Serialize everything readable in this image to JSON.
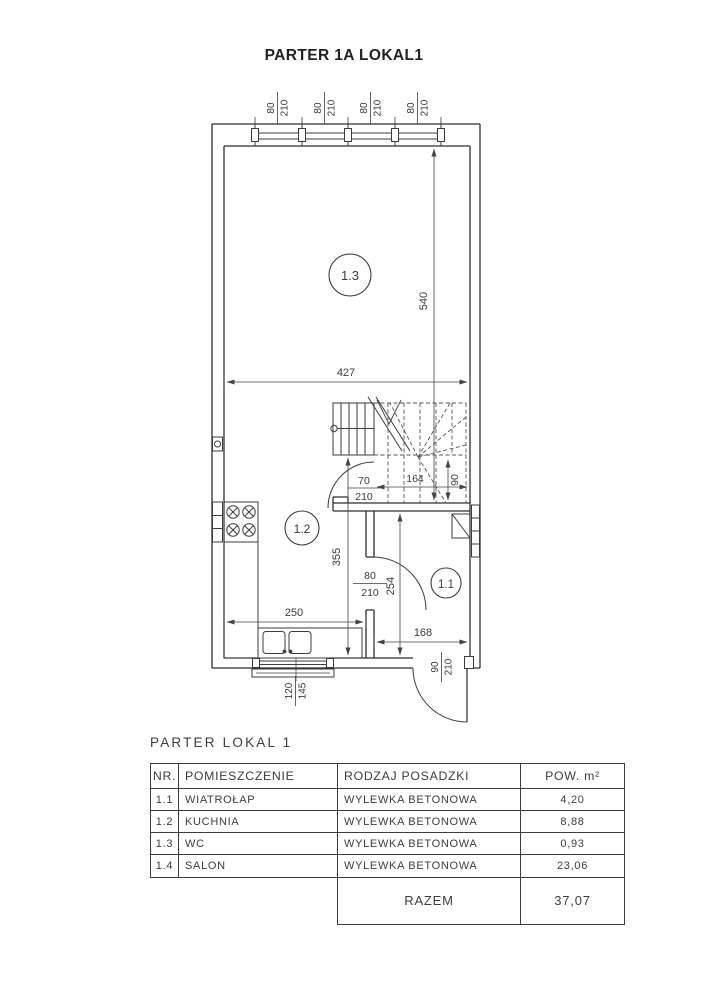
{
  "title": "PARTER 1A LOKAL1",
  "plan": {
    "rooms": [
      {
        "label": "1.3"
      },
      {
        "label": "1.2"
      },
      {
        "label": "1.1"
      }
    ],
    "windows": [
      {
        "num": "80",
        "den": "210"
      },
      {
        "num": "80",
        "den": "210"
      },
      {
        "num": "80",
        "den": "210"
      },
      {
        "num": "80",
        "den": "210"
      }
    ],
    "dims": {
      "d540": "540",
      "d427": "427",
      "d355": "355",
      "d254": "254",
      "d250": "250",
      "d168": "168",
      "d164": "164",
      "d90": "90"
    },
    "fractions": {
      "stair_door": {
        "num": "70",
        "den": "210"
      },
      "interior_door": {
        "num": "80",
        "den": "210"
      },
      "entry_door": {
        "num": "90",
        "den": "210"
      },
      "bottom_window": {
        "num": "120",
        "den": "145"
      }
    }
  },
  "table": {
    "caption": "PARTER LOKAL 1",
    "headers": [
      "NR.",
      "POMIESZCZENIE",
      "RODZAJ POSADZKI",
      "POW. m²"
    ],
    "rows": [
      {
        "nr": "1.1",
        "name": "WIATROŁAP",
        "floor": "WYLEWKA BETONOWA",
        "area": "4,20"
      },
      {
        "nr": "1.2",
        "name": "KUCHNIA",
        "floor": "WYLEWKA BETONOWA",
        "area": "8,88"
      },
      {
        "nr": "1.3",
        "name": "WC",
        "floor": "WYLEWKA BETONOWA",
        "area": "0,93"
      },
      {
        "nr": "1.4",
        "name": "SALON",
        "floor": "WYLEWKA BETONOWA",
        "area": "23,06"
      }
    ],
    "total_label": "RAZEM",
    "total_value": "37,07"
  }
}
